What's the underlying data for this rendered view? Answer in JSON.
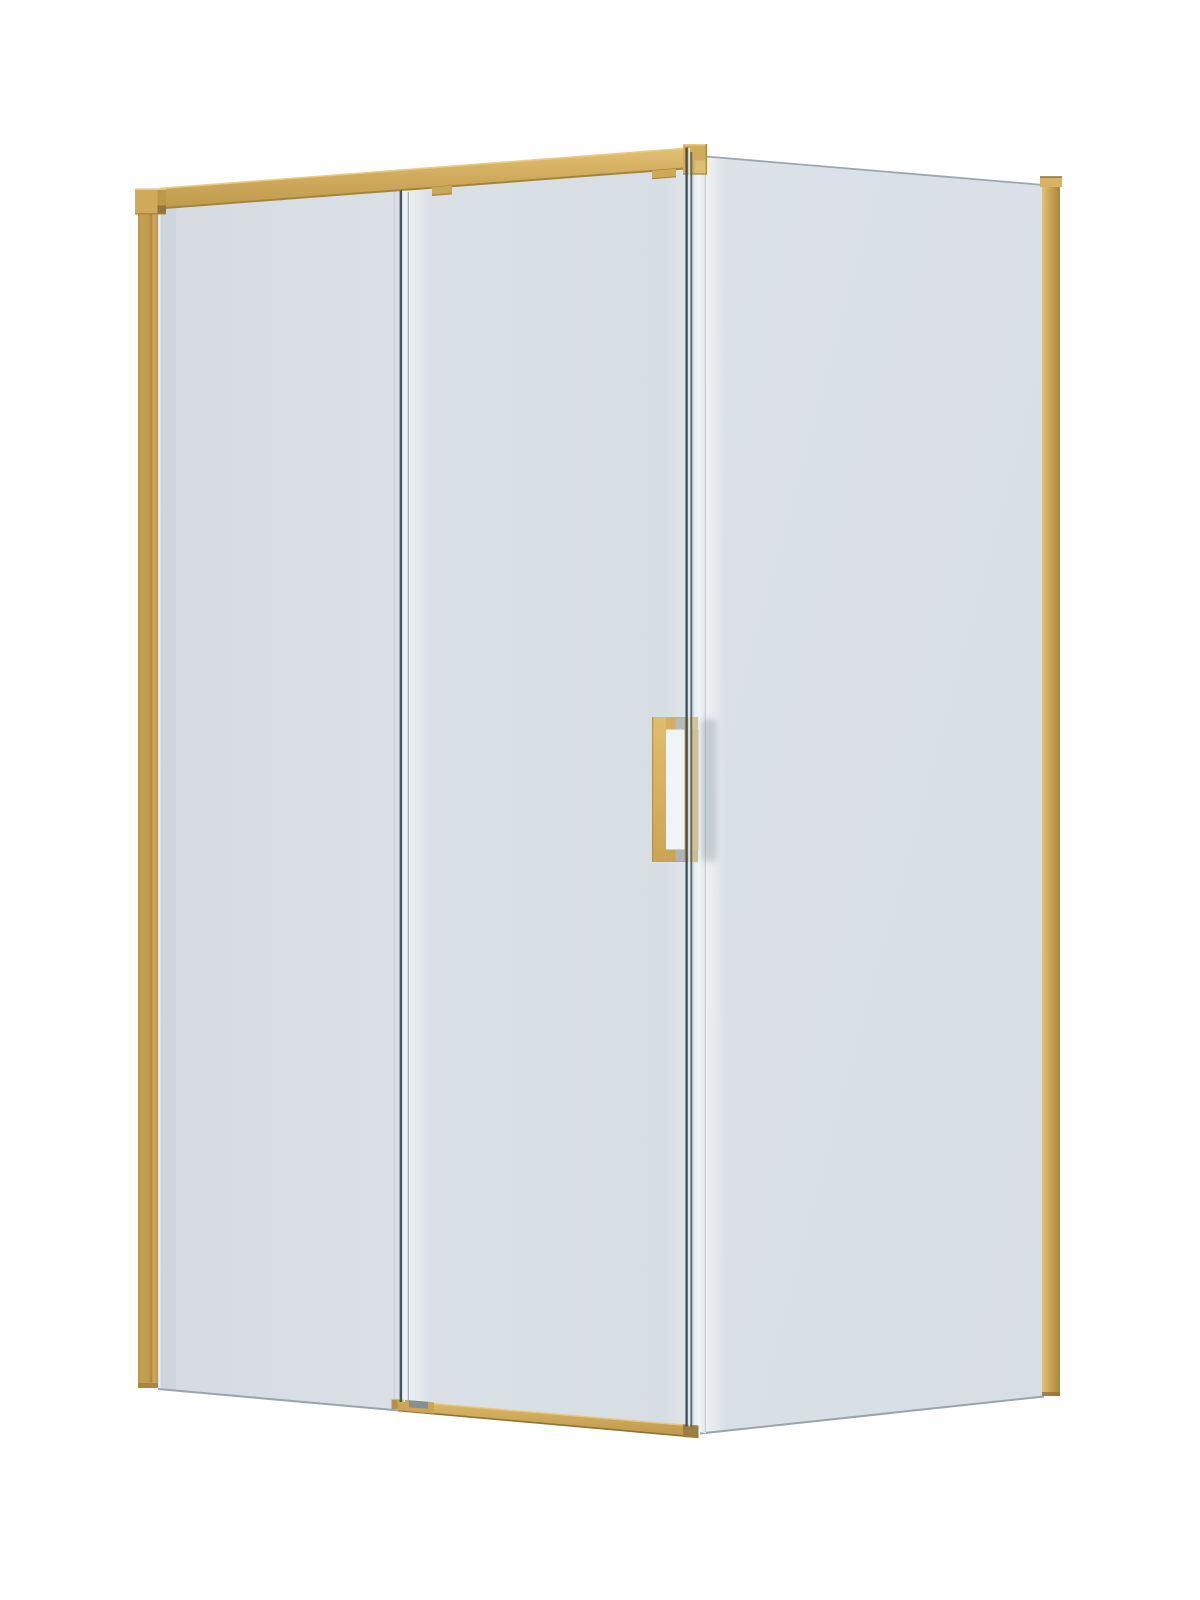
{
  "scene": {
    "subject": "Corner shower enclosure with gold frame and sliding glass door",
    "style": "3D product render on white background",
    "view": "three-quarter front view",
    "background_color": "#FFFFFF",
    "frame_finish": "gold",
    "glass_appearance": "clear glass with light blue-grey tint",
    "parts": [
      {
        "name": "top rail",
        "color": "#D2AC5E"
      },
      {
        "name": "left wall bracket",
        "color": "#D0AA5A"
      },
      {
        "name": "left wall profile",
        "color": "#C6A153"
      },
      {
        "name": "fixed front glass panel",
        "color": "#D8DEE4"
      },
      {
        "name": "sliding door glass",
        "color": "#D8DEE4"
      },
      {
        "name": "door roller hangers",
        "color": "#C9A556"
      },
      {
        "name": "door handle",
        "color": "#D3AF61"
      },
      {
        "name": "bottom track",
        "color": "#C9A050"
      },
      {
        "name": "corner cap",
        "color": "#D6B163"
      },
      {
        "name": "side return glass panel",
        "color": "#D9DFE5"
      },
      {
        "name": "right corner post",
        "color": "#CBA455"
      }
    ]
  },
  "palette": {
    "background": "#FFFFFF",
    "gold": "#D2AC5E",
    "gold_mid": "#D3AF61",
    "gold_light": "#E3C276",
    "gold_dark": "#A8883F",
    "gold_deep": "#8E7335",
    "glass": "#D8DEE4",
    "glass_bright": "#F0F4F7",
    "edge_dark": "#3F4E57",
    "edge_gray": "#9AA7AF",
    "shadow": "#8C99A3"
  }
}
